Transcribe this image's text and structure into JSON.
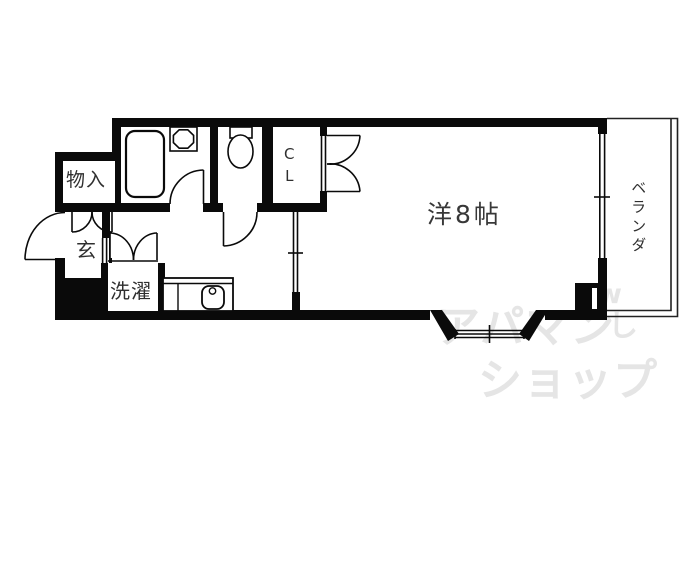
{
  "floorplan": {
    "labels": {
      "main_room": "洋8帖",
      "veranda": "ベランダ",
      "closet": "C\nL",
      "storage": "物入",
      "entrance": "玄",
      "laundry": "洗濯"
    },
    "watermark": {
      "line1": "アパマン",
      "line2": "ショップ",
      "mark_w": "w",
      "mark_shi": "し"
    },
    "colors": {
      "line": "#0a0a0a",
      "label_text": "#2f2f2f",
      "watermark": "#e5e5e5",
      "background": "#ffffff"
    }
  }
}
